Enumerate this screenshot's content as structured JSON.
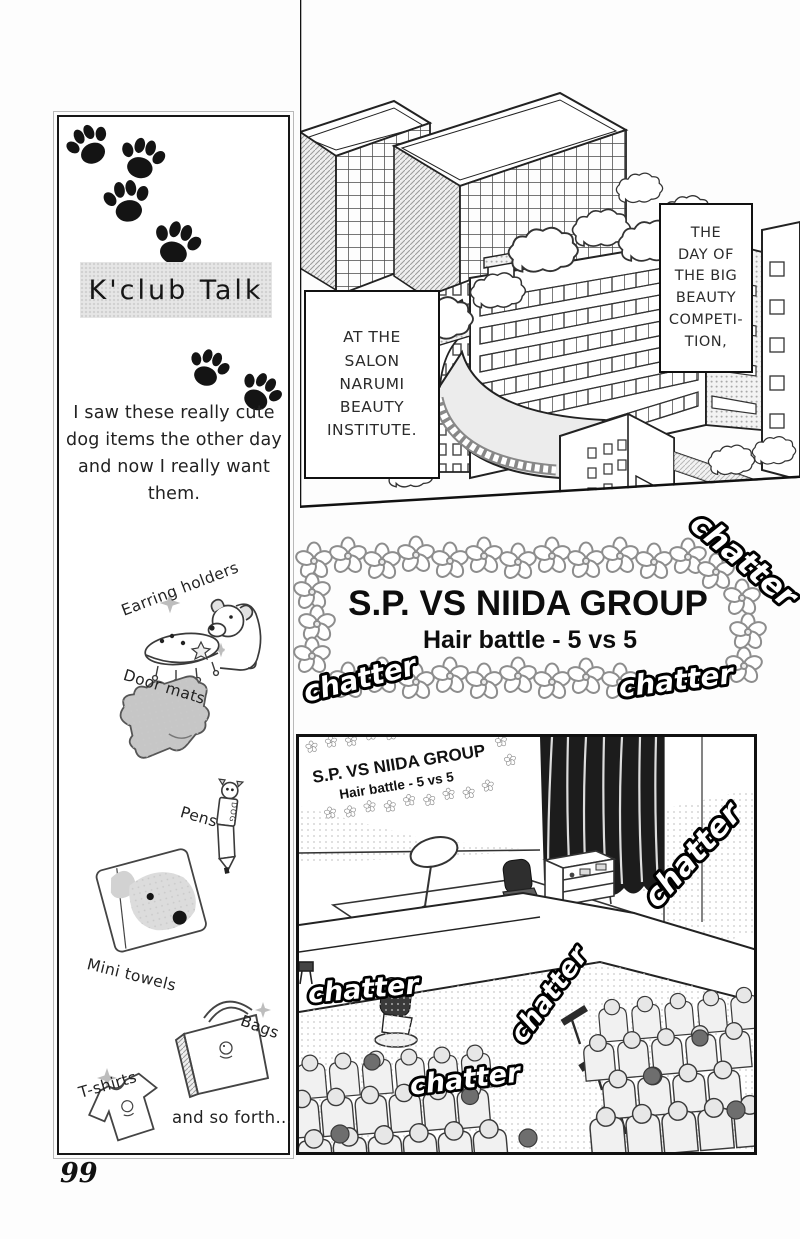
{
  "page": {
    "number": "99"
  },
  "sidebar": {
    "title": "K'club Talk",
    "intro": "I saw these really cute dog items the other day and now I really want them.",
    "items": [
      {
        "label": "Earring holders"
      },
      {
        "label": "Door mats"
      },
      {
        "label": "Pens"
      },
      {
        "label": "Mini towels"
      },
      {
        "label": "Bags"
      },
      {
        "label": "T-shirts"
      }
    ],
    "outro": "and so forth...",
    "pen_label": "DOG"
  },
  "panel_top": {
    "speech_left": "AT THE\nSALON\nNARUMI\nBEAUTY\nINSTITUTE.",
    "speech_right": "THE\nDAY OF\nTHE BIG\nBEAUTY\nCOMPETI-\nTION,"
  },
  "banner": {
    "title": "S.P. VS NIIDA GROUP",
    "subtitle": "Hair battle - 5 vs 5",
    "chatter_label": "chatter"
  },
  "panel_bottom": {
    "sign_title": "S.P. VS NIIDA GROUP",
    "sign_subtitle": "Hair battle - 5 vs 5"
  },
  "colors": {
    "ink": "#1a1a1a",
    "tone_gray": "#d9d9d9",
    "curtain": "#1c1c1c"
  }
}
